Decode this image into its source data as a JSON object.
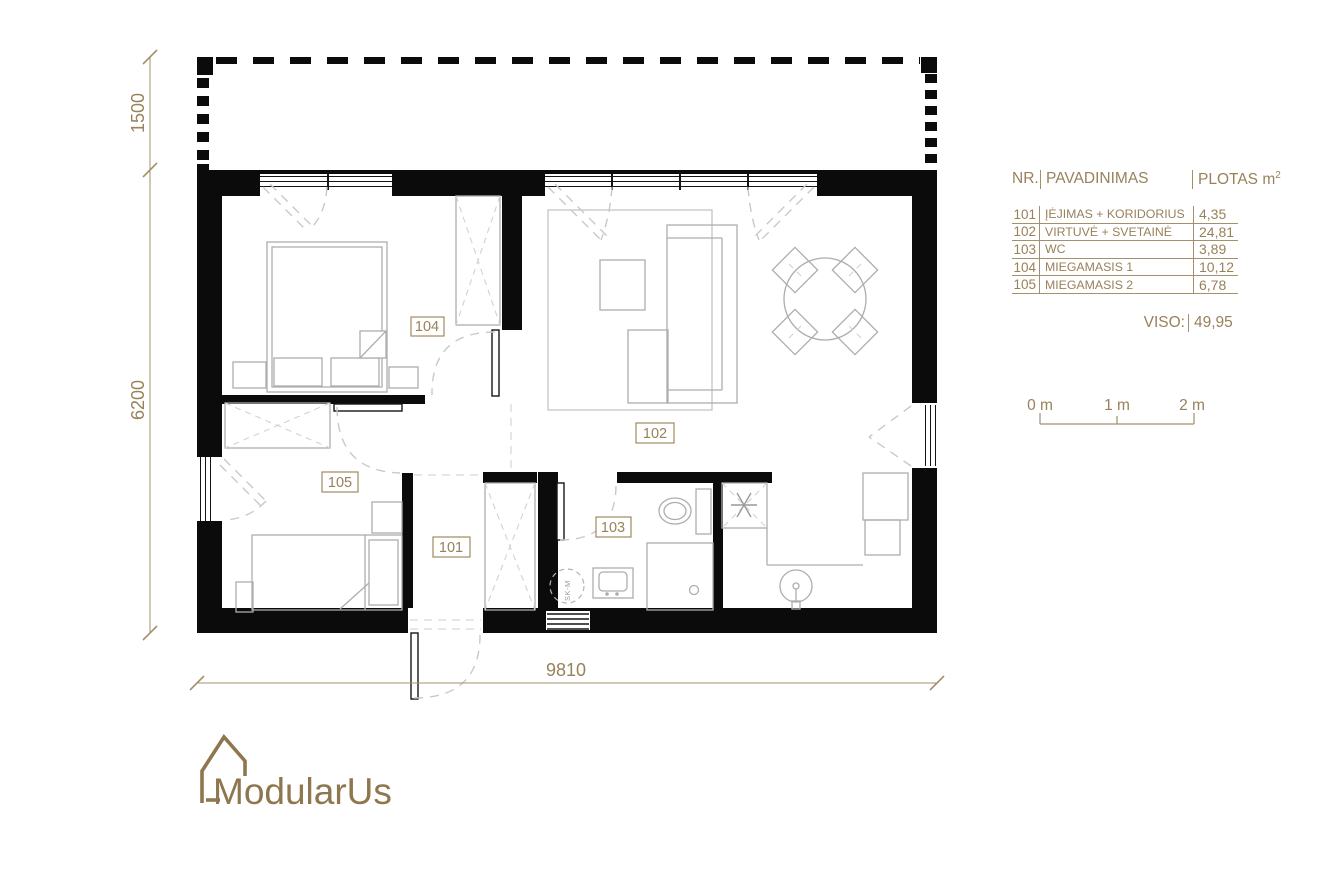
{
  "plan": {
    "room_labels": [
      {
        "number": "101"
      },
      {
        "number": "102"
      },
      {
        "number": "103"
      },
      {
        "number": "104"
      },
      {
        "number": "105"
      }
    ],
    "washer_label": "SK-M",
    "dimensions": {
      "terrace_depth": "1500",
      "house_depth": "6200",
      "house_width": "9810"
    }
  },
  "area_table": {
    "headers": {
      "nr": "NR.",
      "name": "PAVADINIMAS",
      "area": "PLOTAS m",
      "area_sup": "2"
    },
    "rows": [
      {
        "nr": "101",
        "name": "ĮĖJIMAS + KORIDORIUS",
        "area": "4,35"
      },
      {
        "nr": "102",
        "name": "VIRTUVĖ + SVETAINĖ",
        "area": "24,81"
      },
      {
        "nr": "103",
        "name": "WC",
        "area": "3,89"
      },
      {
        "nr": "104",
        "name": "MIEGAMASIS 1",
        "area": "10,12"
      },
      {
        "nr": "105",
        "name": "MIEGAMASIS 2",
        "area": "6,78"
      }
    ],
    "total_label": "VISO:",
    "total_value": "49,95"
  },
  "scale_bar": {
    "labels": [
      "0 m",
      "1 m",
      "2 m"
    ]
  },
  "logo": {
    "text": "ModularUs"
  },
  "colors": {
    "accent_gold": "#98815b",
    "wall_black": "#0b0b0b",
    "furniture_gray": "#adadad"
  }
}
